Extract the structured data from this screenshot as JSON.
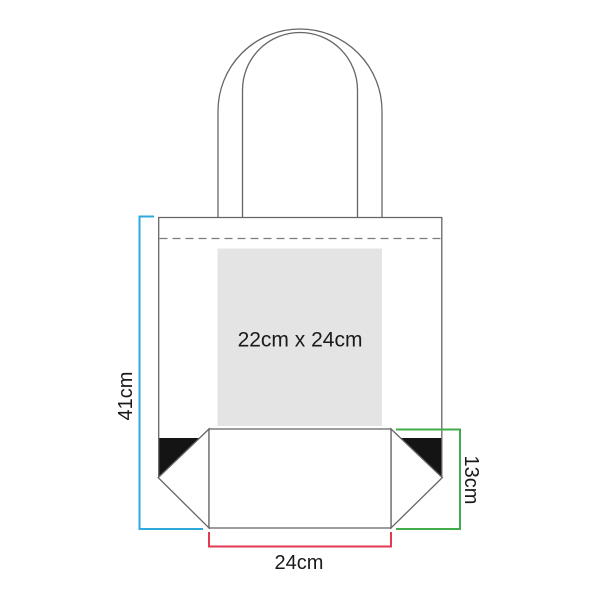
{
  "diagram": {
    "subject": "tote-bag-print-area-dimensions",
    "print_area": {
      "label": "22cm x 24cm",
      "fill": "#e4e4e4"
    },
    "dimensions": {
      "bag_height": {
        "label": "41cm",
        "color": "#2fa9dd"
      },
      "gusset_height": {
        "label": "13cm",
        "color": "#42ab4a"
      },
      "bottom_width": {
        "label": "24cm",
        "color": "#e23a50"
      }
    },
    "styles": {
      "corner_fill": "#141414"
    }
  }
}
